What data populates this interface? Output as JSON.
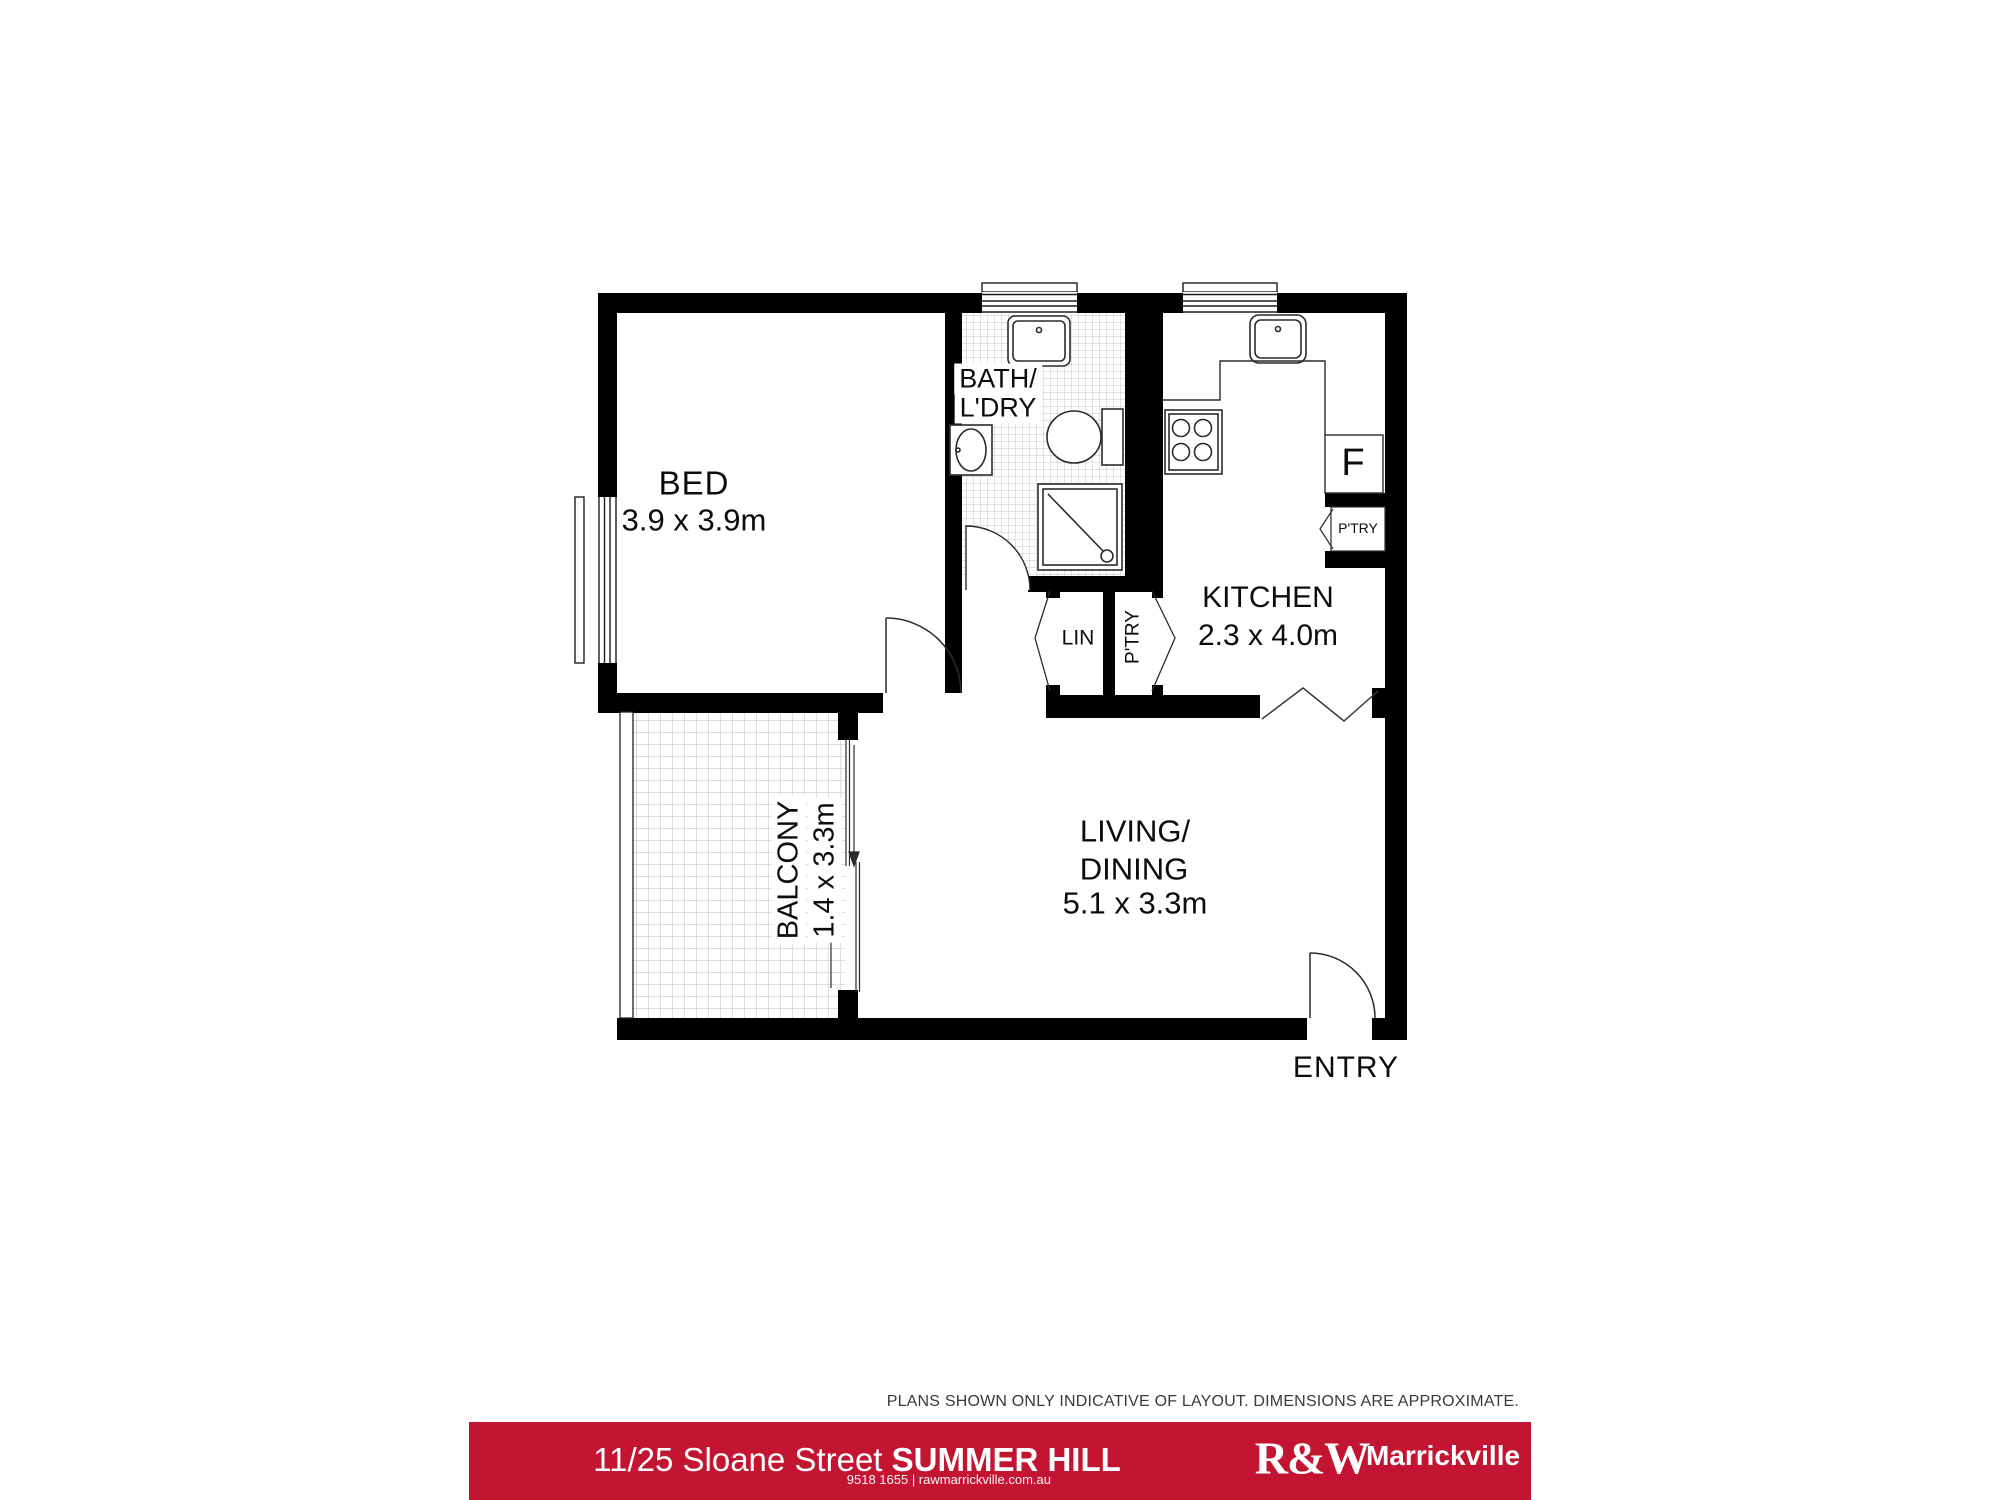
{
  "plan": {
    "rooms": {
      "bed": {
        "name": "BED",
        "dims": "3.9 x 3.9m"
      },
      "bath": {
        "name_line1": "BATH/",
        "name_line2": "L'DRY"
      },
      "kitchen": {
        "name": "KITCHEN",
        "dims": "2.3 x 4.0m"
      },
      "living": {
        "name_line1": "LIVING/",
        "name_line2": "DINING",
        "dims": "5.1 x 3.3m"
      },
      "balcony": {
        "name": "BALCONY",
        "dims": "1.4 x 3.3m"
      },
      "linen": {
        "name": "LIN"
      },
      "pantry_closet": {
        "name": "P'TRY"
      },
      "pantry_niche": {
        "name": "P'TRY"
      },
      "fridge": {
        "name": "F"
      },
      "entry": {
        "name": "ENTRY"
      }
    },
    "disclaimer": "PLANS SHOWN ONLY INDICATIVE OF LAYOUT. DIMENSIONS ARE APPROXIMATE."
  },
  "banner": {
    "address_regular": "11/25 Sloane Street",
    "address_bold": "SUMMER HILL",
    "brand_logo": "R&W",
    "brand_office": "Marrickville",
    "brand_contact": "9518 1655 | rawmarrickville.com.au",
    "brand_color": "#c31432"
  }
}
